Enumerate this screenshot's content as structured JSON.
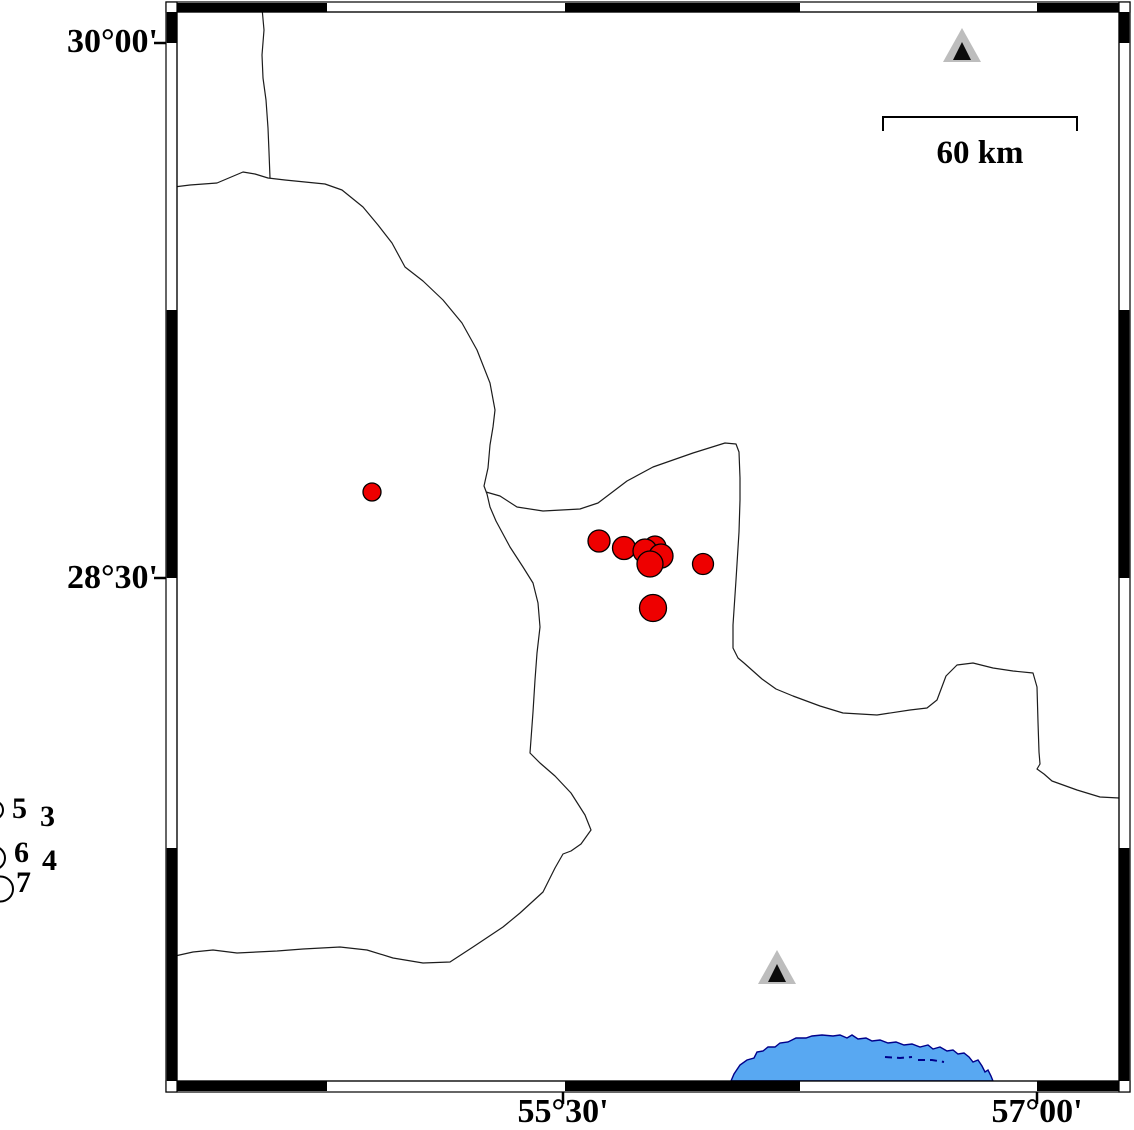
{
  "labels": {
    "lat_top": "30°00'",
    "lat_mid": "28°30'",
    "lon_mid": "55°30'",
    "lon_right": "57°00'",
    "scale_bar": "60 km",
    "legend_mag_5": "5",
    "legend_mag_6": "6",
    "legend_mag_7": "7",
    "legend_mag_3": "3",
    "legend_mag_4": "4"
  },
  "colors": {
    "epicenter_fill": "#ee0000",
    "epicenter_stroke": "#000000",
    "line": "#1c1c1c",
    "water_fill": "#58a8f2",
    "water_stroke": "#00008b",
    "station_gray": "#bdbdbd",
    "station_black": "#0a0a0a",
    "frame_black": "#000000"
  },
  "scale_bar": {
    "x1": 883,
    "x2": 1077,
    "y": 117,
    "drop": 14,
    "label": "60 km"
  },
  "frame": {
    "x": 166,
    "y": 2,
    "w": 964,
    "h": 1090,
    "top_h": 10,
    "bottom_h": 11,
    "side_w": 11,
    "h_black": [
      [
        177,
        327
      ],
      [
        565,
        800
      ],
      [
        1037,
        1119
      ]
    ],
    "v_black": [
      [
        12,
        43
      ],
      [
        310,
        578
      ],
      [
        848,
        1081
      ]
    ],
    "left_ticks_y": [
      43,
      578
    ],
    "bottom_ticks_x": [
      563,
      1037
    ]
  },
  "legend": {
    "circles": [
      {
        "cx": -6,
        "cy": 810,
        "r": 9
      },
      {
        "cx": -6.5,
        "cy": 858,
        "r": 11.5
      },
      {
        "cx": 0.5,
        "cy": 889,
        "r": 12.5
      }
    ]
  },
  "map_features": {
    "earthquakes": [
      {
        "x": 372,
        "y": 492,
        "r": 9
      },
      {
        "x": 599,
        "y": 541,
        "r": 11
      },
      {
        "x": 624,
        "y": 548,
        "r": 11.5
      },
      {
        "x": 655,
        "y": 547,
        "r": 11
      },
      {
        "x": 645,
        "y": 551,
        "r": 12
      },
      {
        "x": 661,
        "y": 556,
        "r": 12
      },
      {
        "x": 650,
        "y": 564,
        "r": 13
      },
      {
        "x": 703,
        "y": 564,
        "r": 10.5
      },
      {
        "x": 653,
        "y": 608,
        "r": 13.5
      }
    ],
    "stations": [
      {
        "cx": 962,
        "base_y": 62
      },
      {
        "cx": 777,
        "base_y": 984
      }
    ],
    "boundary_lines": [
      [
        [
          262,
          8
        ],
        [
          264,
          30
        ],
        [
          262,
          55
        ],
        [
          263,
          78
        ],
        [
          266,
          100
        ],
        [
          268,
          128
        ],
        [
          269,
          152
        ],
        [
          270,
          178
        ]
      ],
      [
        [
          166,
          188
        ],
        [
          190,
          185
        ],
        [
          217,
          183
        ],
        [
          243,
          172
        ],
        [
          255,
          174
        ],
        [
          268,
          178
        ],
        [
          285,
          180
        ],
        [
          305,
          182
        ],
        [
          325,
          184
        ],
        [
          342,
          190
        ],
        [
          363,
          207
        ],
        [
          378,
          225
        ],
        [
          392,
          243
        ],
        [
          405,
          267
        ],
        [
          423,
          281
        ],
        [
          443,
          300
        ],
        [
          462,
          323
        ],
        [
          477,
          350
        ],
        [
          490,
          383
        ],
        [
          495,
          410
        ],
        [
          493,
          427
        ],
        [
          490,
          445
        ],
        [
          488,
          468
        ],
        [
          484,
          486
        ],
        [
          487,
          494
        ],
        [
          490,
          507
        ],
        [
          496,
          521
        ],
        [
          510,
          547
        ],
        [
          523,
          567
        ],
        [
          533,
          583
        ],
        [
          538,
          603
        ],
        [
          540,
          627
        ],
        [
          537,
          653
        ],
        [
          535,
          680
        ],
        [
          533,
          712
        ],
        [
          530,
          753
        ],
        [
          540,
          763
        ],
        [
          555,
          776
        ],
        [
          571,
          793
        ],
        [
          585,
          815
        ],
        [
          591,
          830
        ],
        [
          581,
          844
        ],
        [
          571,
          851
        ],
        [
          563,
          854
        ],
        [
          555,
          868
        ],
        [
          548,
          882
        ],
        [
          543,
          892
        ],
        [
          520,
          913
        ],
        [
          503,
          927
        ],
        [
          473,
          947
        ],
        [
          450,
          962
        ],
        [
          423,
          963
        ],
        [
          393,
          958
        ],
        [
          367,
          950
        ],
        [
          340,
          947
        ],
        [
          303,
          949
        ],
        [
          277,
          951
        ],
        [
          237,
          953
        ],
        [
          213,
          950
        ],
        [
          193,
          952
        ],
        [
          166,
          958
        ]
      ],
      [
        [
          486,
          492
        ],
        [
          500,
          496
        ],
        [
          517,
          507
        ],
        [
          543,
          511
        ],
        [
          580,
          509
        ],
        [
          598,
          503
        ],
        [
          627,
          481
        ],
        [
          653,
          467
        ],
        [
          693,
          453
        ],
        [
          725,
          443
        ],
        [
          736,
          444
        ],
        [
          739,
          452
        ],
        [
          740,
          478
        ],
        [
          740,
          500
        ],
        [
          739,
          532
        ],
        [
          736,
          580
        ],
        [
          733,
          625
        ],
        [
          733,
          648
        ],
        [
          738,
          658
        ],
        [
          744,
          663
        ],
        [
          753,
          671
        ],
        [
          762,
          679
        ],
        [
          776,
          689
        ],
        [
          793,
          696
        ],
        [
          820,
          706
        ],
        [
          843,
          713
        ],
        [
          877,
          715
        ],
        [
          910,
          710
        ],
        [
          927,
          708
        ],
        [
          937,
          700
        ],
        [
          946,
          676
        ],
        [
          957,
          665
        ],
        [
          973,
          663
        ],
        [
          993,
          668
        ],
        [
          1013,
          671
        ],
        [
          1033,
          673
        ],
        [
          1037,
          687
        ],
        [
          1038,
          722
        ],
        [
          1039,
          752
        ],
        [
          1040,
          764
        ],
        [
          1037,
          769
        ],
        [
          1044,
          774
        ],
        [
          1052,
          781
        ],
        [
          1077,
          790
        ],
        [
          1100,
          797
        ],
        [
          1119,
          798
        ]
      ]
    ],
    "water": {
      "outline": [
        [
          731,
          1081
        ],
        [
          734,
          1074
        ],
        [
          740,
          1065
        ],
        [
          747,
          1060
        ],
        [
          754,
          1058
        ],
        [
          757,
          1052
        ],
        [
          763,
          1051
        ],
        [
          768,
          1047
        ],
        [
          775,
          1047
        ],
        [
          780,
          1043
        ],
        [
          788,
          1042
        ],
        [
          796,
          1038
        ],
        [
          806,
          1038
        ],
        [
          812,
          1036
        ],
        [
          822,
          1035
        ],
        [
          833,
          1036
        ],
        [
          840,
          1035
        ],
        [
          847,
          1038
        ],
        [
          852,
          1035
        ],
        [
          858,
          1039
        ],
        [
          866,
          1038
        ],
        [
          872,
          1041
        ],
        [
          880,
          1040
        ],
        [
          888,
          1043
        ],
        [
          896,
          1042
        ],
        [
          904,
          1045
        ],
        [
          912,
          1044
        ],
        [
          920,
          1047
        ],
        [
          928,
          1045
        ],
        [
          933,
          1049
        ],
        [
          940,
          1047
        ],
        [
          947,
          1051
        ],
        [
          953,
          1050
        ],
        [
          958,
          1054
        ],
        [
          964,
          1053
        ],
        [
          969,
          1057
        ],
        [
          973,
          1062
        ],
        [
          978,
          1060
        ],
        [
          982,
          1066
        ],
        [
          985,
          1072
        ],
        [
          988,
          1070
        ],
        [
          991,
          1076
        ],
        [
          993,
          1081
        ]
      ],
      "dashes": [
        [
          [
            885,
            1057
          ],
          [
            900,
            1058
          ],
          [
            912,
            1057
          ]
        ],
        [
          [
            918,
            1060
          ],
          [
            932,
            1060
          ],
          [
            944,
            1062
          ]
        ]
      ]
    }
  }
}
